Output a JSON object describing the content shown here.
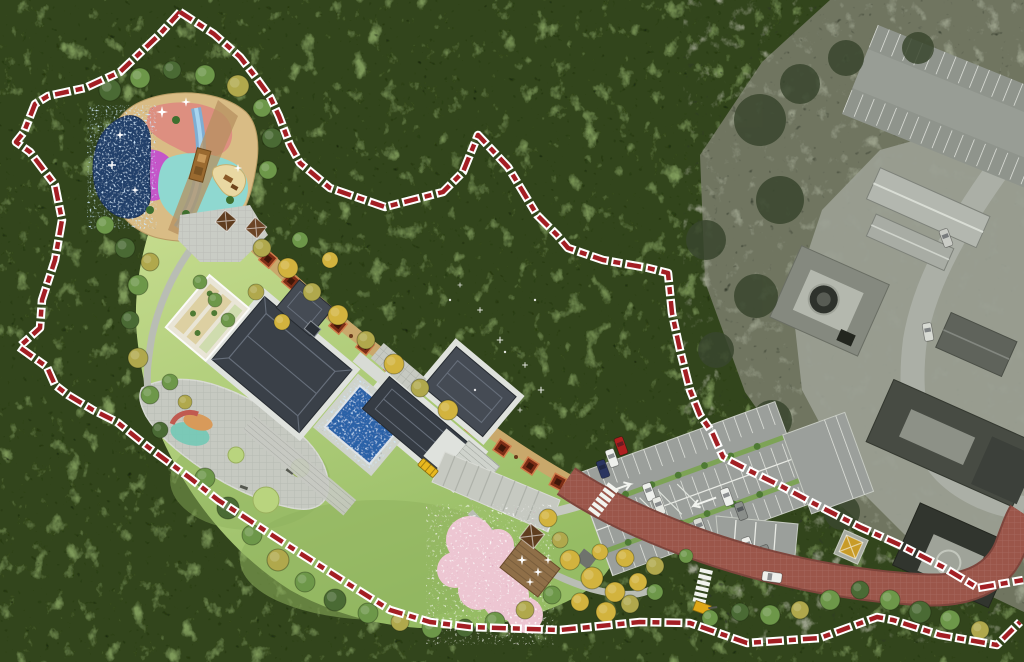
{
  "meta": {
    "title": "Landscape site master plan over aerial photograph",
    "description": "Colored site plan (playground, hall complex, lawn, promenade, parking, access road) set into a forested aerial photo; retained existing campus shown in grayscale at right; site limit drawn as red dashed boundary."
  },
  "colors": {
    "forest_base": "#33451f",
    "forest_light": "#7e9a5a",
    "forest_shadow": "#16220f",
    "photo_base": "#6f7560",
    "photo_light": "#9aa08a",
    "photo_shadow": "#2c3526",
    "photo_ground": "#9ba094",
    "lawn_top": "#c6dc8e",
    "lawn_bottom": "#96bc64",
    "meadow": "#8fb25e",
    "promenade": "#c9a86b",
    "planter": "#7c2d16",
    "roof_dark": "#3a4048",
    "roof_mid": "#454b54",
    "roof_wing": "#363c44",
    "walkway": "#dfe2dd",
    "paving": "#c6c9c1",
    "pool_water": "#2b62a8",
    "pond_navy": "#23406b",
    "road": "#9b564a",
    "road_edge": "#7e453c",
    "parking": "#9b9f9b",
    "median_green": "#7da356",
    "marking_white": "#f2f4ef",
    "boundary_red": "#a31f24",
    "boundary_casing": "#ffffff",
    "play_base": "#d9bc85",
    "play_salmon": "#dd8f80",
    "play_magenta": "#c455c8",
    "play_cyan": "#8fd8d0",
    "play_blue": "#6fb3e0",
    "play_sand": "#e9d8a2",
    "blossom": "#edc6d2",
    "tree_yellow": "#d2b33e",
    "tree_olive": "#b0a84c",
    "tree_green": "#6d9749",
    "tree_dark": "#4a6a34",
    "pavilion_brown": "#5f3d1f",
    "deck_brown": "#8f6f48",
    "bus_yellow": "#e8b81e",
    "car_red": "#b02020",
    "car_white": "#eef0ec",
    "car_navy": "#2a3560",
    "car_gray": "#8a8e8a",
    "pavilion_yellow": "#c89b28"
  },
  "features": [
    {
      "id": "site-boundary",
      "label": "Site boundary (red dashed line)"
    },
    {
      "id": "forest",
      "label": "Forested hillside"
    },
    {
      "id": "existing-campus",
      "label": "Existing campus (grayscale aerial photo)"
    },
    {
      "id": "children-playground",
      "label": "Children's playground with water play pond"
    },
    {
      "id": "main-hall-complex",
      "label": "Main hall courtyard complex"
    },
    {
      "id": "reflecting-pool",
      "label": "Reflecting pool"
    },
    {
      "id": "terraced-garden",
      "label": "Terraced planting garden"
    },
    {
      "id": "great-lawn",
      "label": "Great lawn"
    },
    {
      "id": "promenade",
      "label": "Promenade trail with planter boxes"
    },
    {
      "id": "west-plaza",
      "label": "West plaza with lawn circles"
    },
    {
      "id": "entry-plaza",
      "label": "Entry steps and plaza"
    },
    {
      "id": "cherry-garden",
      "label": "Cherry blossom garden with deck and pavilion"
    },
    {
      "id": "parking",
      "label": "Visitor parking lot"
    },
    {
      "id": "access-road",
      "label": "Access road with crosswalks"
    }
  ]
}
